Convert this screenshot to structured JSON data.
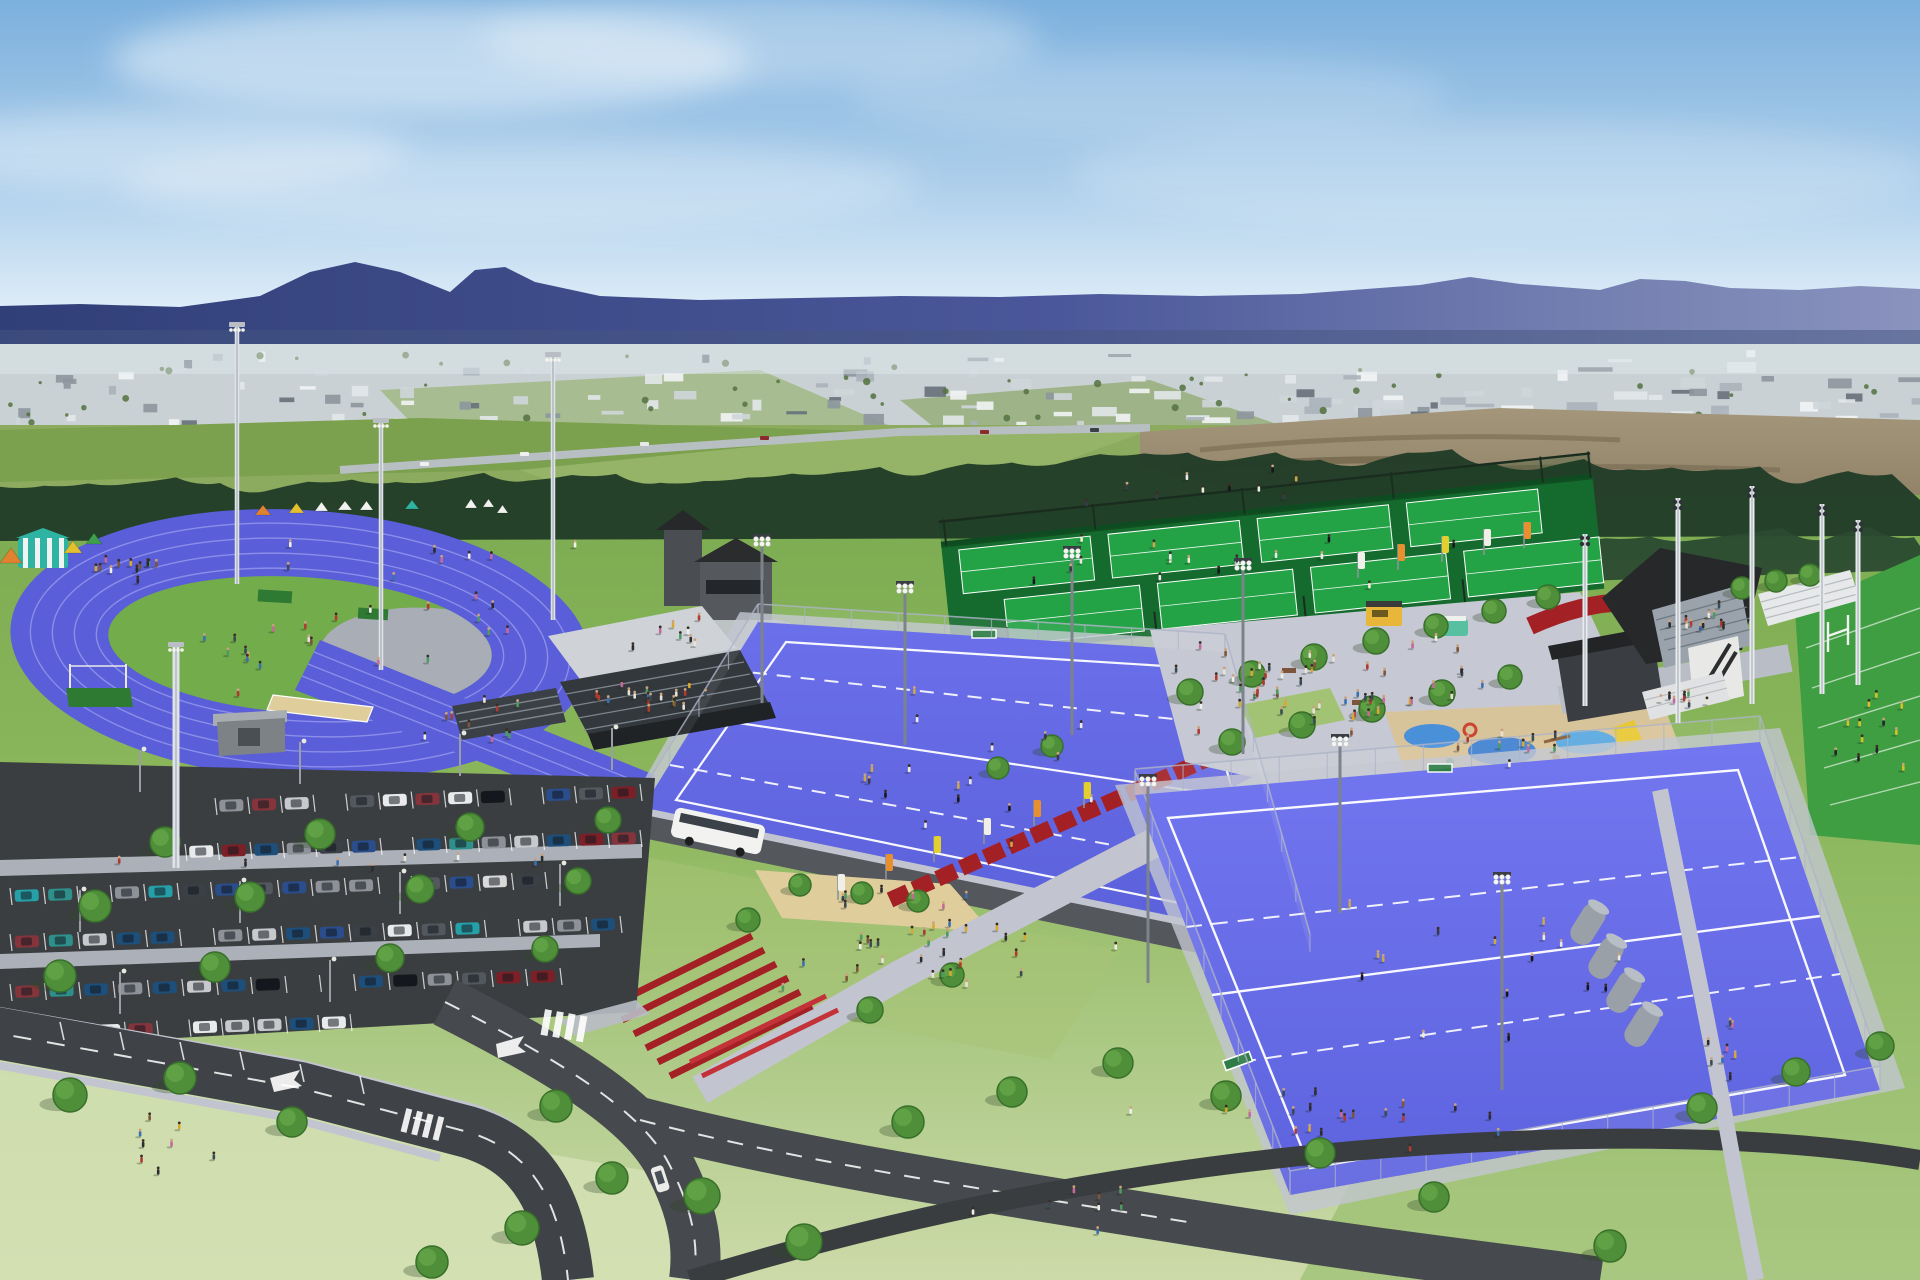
{
  "scene_type": "aerial-render-sports-park",
  "colors": {
    "sky_top": "#7cb0dd",
    "sky_mid": "#aecfeb",
    "sky_horizon": "#eaf4fb",
    "cloud": "#ffffff",
    "mountain_near": "#33417a",
    "mountain_far": "#7d88b5",
    "city_base": "#c9d1d4",
    "city_haze": "#dfe9ee",
    "field_green": "#8cab5e",
    "field_green2": "#7ba04e",
    "dirt_brown": "#97866a",
    "dirt_dark": "#6f6149",
    "treeline": "#223d28",
    "treeline2": "#2b4a31",
    "ground_top": "#7cab51",
    "ground_mid": "#8cb75c",
    "ground_pale": "#ccdaa9",
    "track_surface": "#5a5ed8",
    "track_lane": "#8a8ee8",
    "track_infield": "#73ac4b",
    "turf_blue": "#6b70ea",
    "turf_blue_deep": "#5a5fda",
    "turf_line": "#ffffff",
    "tennis_court": "#23a246",
    "tennis_surround": "#156b2e",
    "tennis_fence": "#1c2a1f",
    "red_walkway": "#a32125",
    "red_bright": "#c23238",
    "plaza_concrete": "#c6c9d3",
    "path_gray": "#c2c5cf",
    "walk_light": "#b9bdc6",
    "asphalt": "#3b3e41",
    "road": "#46494d",
    "road_dark": "#3a3d40",
    "roof_dark": "#27292c",
    "roof_black": "#202224",
    "wall_gray": "#8e9399",
    "glass_blue": "#7c94ad",
    "canopy_roof": "#cfd3d8",
    "bleacher_white": "#e6e8ea",
    "stand_body": "#33383c",
    "seat_gray": "#9aa3ab",
    "sand": "#e0cd9c",
    "playground_sand": "#d8c49a",
    "playground_blue": "#4a90d8",
    "rugby_green": "#3f9e41",
    "tank_gray": "#9aa0a8",
    "tree_canopy": "#4f8f3a",
    "tree_rim": "#38702a",
    "tree_light": "#66a848",
    "tree_shadow": "rgba(45,70,40,0.30)",
    "fence": "#aeb4c8",
    "bus_white": "#f2f2f0",
    "food_truck_yellow": "#e8b73a",
    "van_green": "#57c0a0",
    "hijump_green": "#2f7a33",
    "goal_green": "#2e7d46"
  },
  "scene": {
    "city": {
      "buildings": 130,
      "greens": 55
    },
    "distant_cars": [
      [
        420,
        462
      ],
      [
        520,
        452
      ],
      [
        640,
        442
      ],
      [
        760,
        436
      ],
      [
        980,
        430
      ],
      [
        1090,
        428
      ]
    ],
    "marquee": {
      "x": 18,
      "y": 538,
      "w": 50,
      "h": 30,
      "color": "#2fb3a3"
    },
    "tents": [
      [
        0,
        548,
        22,
        15,
        "#e0822f"
      ],
      [
        64,
        541,
        18,
        12,
        "#e3c030"
      ],
      [
        86,
        533,
        16,
        11,
        "#3f9e4e"
      ],
      [
        255,
        505,
        16,
        10,
        "#e0822f"
      ],
      [
        289,
        503,
        15,
        10,
        "#e3c030"
      ],
      [
        315,
        502,
        13,
        9,
        "#f2f2ee"
      ],
      [
        338,
        501,
        14,
        9,
        "#f2f2ee"
      ],
      [
        360,
        501,
        13,
        9,
        "#f2f2ee"
      ],
      [
        405,
        500,
        14,
        9,
        "#2fb3a3"
      ],
      [
        465,
        499,
        12,
        9,
        "#f2f2ee"
      ],
      [
        483,
        499,
        11,
        8,
        "#f2f2ee"
      ],
      [
        497,
        505,
        11,
        8,
        "#f2f2ee"
      ]
    ],
    "trees": [
      [
        165,
        842,
        15
      ],
      [
        320,
        834,
        15
      ],
      [
        470,
        827,
        14
      ],
      [
        608,
        820,
        13
      ],
      [
        95,
        906,
        16
      ],
      [
        250,
        897,
        15
      ],
      [
        420,
        889,
        14
      ],
      [
        578,
        881,
        13
      ],
      [
        60,
        976,
        16
      ],
      [
        215,
        967,
        15
      ],
      [
        390,
        958,
        14
      ],
      [
        545,
        949,
        13
      ],
      [
        800,
        885,
        11
      ],
      [
        862,
        893,
        11
      ],
      [
        918,
        901,
        11
      ],
      [
        748,
        920,
        12
      ],
      [
        70,
        1095,
        17
      ],
      [
        180,
        1078,
        16
      ],
      [
        292,
        1122,
        15
      ],
      [
        556,
        1106,
        16
      ],
      [
        612,
        1178,
        16
      ],
      [
        522,
        1228,
        17
      ],
      [
        432,
        1262,
        16
      ],
      [
        702,
        1196,
        18
      ],
      [
        804,
        1242,
        18
      ],
      [
        908,
        1122,
        16
      ],
      [
        1012,
        1092,
        15
      ],
      [
        1118,
        1063,
        15
      ],
      [
        1226,
        1096,
        15
      ],
      [
        1320,
        1153,
        15
      ],
      [
        1434,
        1197,
        15
      ],
      [
        1610,
        1246,
        16
      ],
      [
        1702,
        1108,
        15
      ],
      [
        1796,
        1072,
        14
      ],
      [
        1880,
        1046,
        14
      ],
      [
        1190,
        692,
        13
      ],
      [
        1252,
        674,
        13
      ],
      [
        1314,
        657,
        13
      ],
      [
        1376,
        641,
        13
      ],
      [
        1436,
        626,
        12
      ],
      [
        1494,
        611,
        12
      ],
      [
        1548,
        597,
        12
      ],
      [
        1232,
        742,
        13
      ],
      [
        1302,
        725,
        13
      ],
      [
        1372,
        709,
        13
      ],
      [
        1442,
        693,
        13
      ],
      [
        1510,
        677,
        12
      ],
      [
        1742,
        588,
        11
      ],
      [
        1776,
        581,
        11
      ],
      [
        1810,
        575,
        11
      ],
      [
        998,
        768,
        11
      ],
      [
        1052,
        746,
        11
      ],
      [
        870,
        1010,
        13
      ],
      [
        952,
        975,
        12
      ]
    ],
    "parking": {
      "rows": [
        {
          "x0": 215,
          "y0": 806,
          "x1": 640,
          "y1": 792,
          "n": 13,
          "skip": [
            3,
            9
          ]
        },
        {
          "x0": 185,
          "y0": 852,
          "x1": 640,
          "y1": 838,
          "n": 14,
          "skip": [
            6
          ]
        },
        {
          "x0": 10,
          "y0": 896,
          "x1": 545,
          "y1": 880,
          "n": 16,
          "skip": [
            2,
            11
          ]
        },
        {
          "x0": 10,
          "y0": 942,
          "x1": 620,
          "y1": 924,
          "n": 18,
          "skip": [
            5,
            14
          ]
        },
        {
          "x0": 10,
          "y0": 992,
          "x1": 560,
          "y1": 976,
          "n": 16,
          "skip": [
            8,
            9
          ]
        },
        {
          "x0": 60,
          "y0": 1032,
          "x1": 350,
          "y1": 1022,
          "n": 9,
          "skip": [
            3
          ]
        }
      ],
      "lamps": [
        [
          140,
          792
        ],
        [
          300,
          784
        ],
        [
          460,
          776
        ],
        [
          612,
          770
        ],
        [
          80,
          932
        ],
        [
          240,
          923
        ],
        [
          400,
          914
        ],
        [
          560,
          906
        ],
        [
          120,
          1014
        ],
        [
          330,
          1002
        ]
      ],
      "car_colors": [
        "#e9eaec",
        "#15171c",
        "#3b3f46",
        "#8e9298",
        "#7c1f26",
        "#2a4d8c",
        "#2f8f8a",
        "#c7c9cc",
        "#53575e",
        "#1d4f7a",
        "#86343c",
        "#d9d9d9",
        "#26a0a8"
      ]
    },
    "people_clusters": [
      [
        300,
        645,
        16,
        150,
        55,
        0
      ],
      [
        120,
        572,
        12,
        70,
        18,
        0
      ],
      [
        430,
        560,
        8,
        150,
        20,
        0
      ],
      [
        480,
        715,
        10,
        120,
        30,
        0
      ],
      [
        350,
        862,
        8,
        250,
        12,
        0
      ],
      [
        1330,
        685,
        55,
        170,
        55,
        0
      ],
      [
        900,
        940,
        24,
        150,
        60,
        0
      ],
      [
        985,
        780,
        18,
        180,
        95,
        1
      ],
      [
        1500,
        950,
        16,
        230,
        110,
        1
      ],
      [
        1000,
        950,
        14,
        150,
        40,
        0
      ],
      [
        1350,
        1120,
        20,
        260,
        35,
        0
      ],
      [
        1265,
        565,
        16,
        270,
        45,
        1
      ],
      [
        660,
        700,
        20,
        75,
        20,
        0
      ],
      [
        1700,
        622,
        12,
        45,
        16,
        0
      ],
      [
        1868,
        737,
        12,
        45,
        45,
        2
      ],
      [
        160,
        1150,
        8,
        90,
        40,
        0
      ],
      [
        1725,
        1050,
        8,
        30,
        80,
        0
      ],
      [
        1100,
        1210,
        8,
        180,
        25,
        0
      ],
      [
        1690,
        700,
        8,
        40,
        10,
        0
      ],
      [
        1520,
        750,
        10,
        90,
        25,
        0
      ],
      [
        480,
        620,
        6,
        60,
        25,
        0
      ],
      [
        1240,
        490,
        10,
        200,
        25,
        1
      ],
      [
        680,
        640,
        8,
        60,
        30,
        0
      ]
    ],
    "people_palettes": {
      "mixed": [
        "#2b2b30",
        "#e8e2d6",
        "#b03a30",
        "#3a6fb0",
        "#d8a830",
        "#c46a9a",
        "#4e9a62",
        "#f0eee8",
        "#7c553a",
        "#3a4a55"
      ],
      "sport": [
        "#16161a",
        "#f0ead6",
        "#e8e8e8",
        "#3a3a46",
        "#caa84a"
      ],
      "yellow_team": [
        "#d4c22a",
        "#23232a",
        "#d4c22a"
      ]
    },
    "floodlights": [
      [
        237,
        322,
        262,
        "T"
      ],
      [
        381,
        418,
        252,
        "T"
      ],
      [
        553,
        352,
        268,
        "T"
      ],
      [
        176,
        642,
        226,
        "P"
      ],
      [
        762,
        538,
        165,
        "C"
      ],
      [
        1072,
        550,
        185,
        "C"
      ],
      [
        1243,
        562,
        192,
        "C"
      ],
      [
        905,
        585,
        160,
        "C"
      ],
      [
        1148,
        778,
        205,
        "C"
      ],
      [
        1502,
        876,
        214,
        "C"
      ],
      [
        1340,
        738,
        175,
        "C"
      ],
      [
        1678,
        498,
        225,
        "W"
      ],
      [
        1752,
        486,
        218,
        "W"
      ],
      [
        1822,
        504,
        190,
        "W"
      ],
      [
        1858,
        520,
        165,
        "W"
      ],
      [
        1585,
        534,
        172,
        "W"
      ]
    ],
    "banners": {
      "entry": [
        [
          838,
          900
        ],
        [
          886,
          880
        ],
        [
          934,
          862
        ],
        [
          984,
          844
        ],
        [
          1034,
          826
        ],
        [
          1084,
          808
        ]
      ],
      "plaza": [
        [
          1358,
          578
        ],
        [
          1398,
          570
        ],
        [
          1442,
          562
        ],
        [
          1484,
          555
        ],
        [
          1524,
          548
        ]
      ],
      "colors": [
        "#f0efe8",
        "#e8902f",
        "#e3cf30"
      ]
    },
    "tanks": [
      [
        1588,
        924
      ],
      [
        1606,
        958
      ],
      [
        1624,
        992
      ],
      [
        1642,
        1026
      ]
    ],
    "fences": [
      {
        "x1": 758,
        "y1": 622,
        "x2": 640,
        "y2": 812,
        "h": 18
      },
      {
        "x1": 758,
        "y1": 622,
        "x2": 1225,
        "y2": 652,
        "h": 18
      },
      {
        "x1": 1225,
        "y1": 652,
        "x2": 1310,
        "y2": 952,
        "h": 18
      },
      {
        "x1": 1135,
        "y1": 795,
        "x2": 1760,
        "y2": 742,
        "h": 26
      },
      {
        "x1": 1135,
        "y1": 795,
        "x2": 1290,
        "y2": 1195,
        "h": 24
      },
      {
        "x1": 1760,
        "y1": 742,
        "x2": 1880,
        "y2": 1090,
        "h": 26
      },
      {
        "x1": 1290,
        "y1": 1195,
        "x2": 1880,
        "y2": 1090,
        "h": 24
      }
    ]
  }
}
